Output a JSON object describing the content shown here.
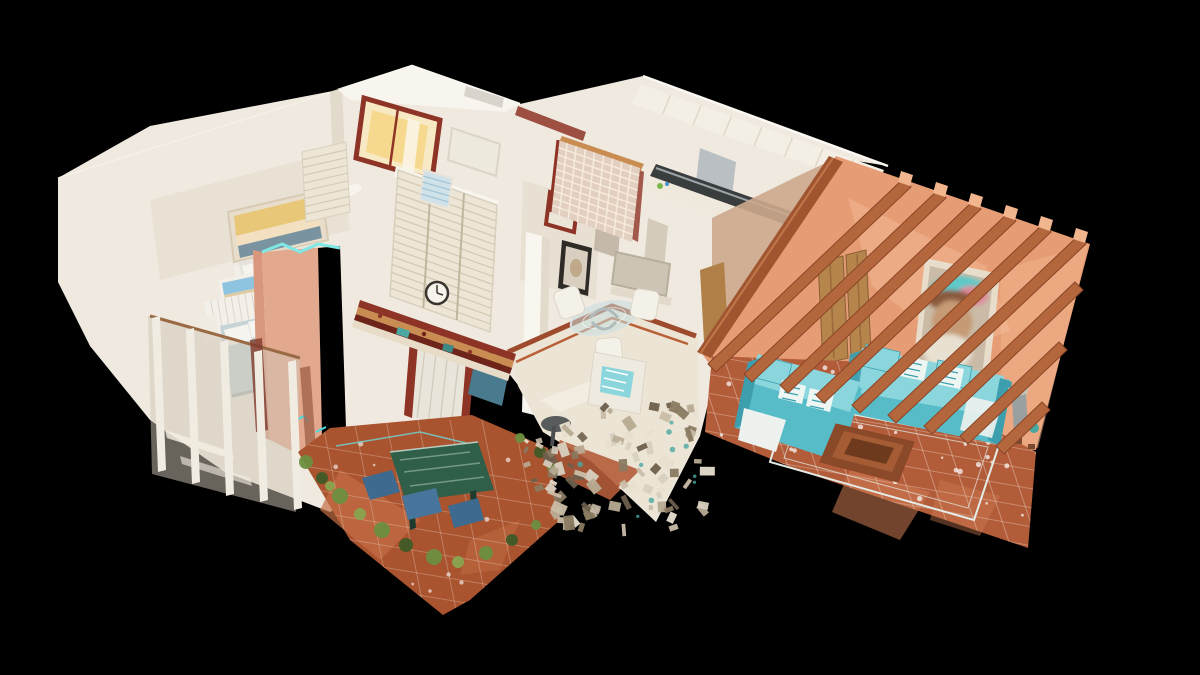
{
  "scene": {
    "description": "3D dollhouse cutaway scan of a villa viewed from above on black",
    "regions": [
      "upper-bathroom",
      "bedroom-upper",
      "bedroom-lower",
      "balcony",
      "chimney",
      "hallway",
      "kitchen",
      "dining-area",
      "patio-terrace",
      "lounge"
    ],
    "palette": {
      "bg": "#000000",
      "wall_white": "#efe9df",
      "wall_bright": "#f8f5ee",
      "wall_shadow": "#e2dacb",
      "wall_shadow2": "#cfc6b6",
      "wall_pink_shadow": "#cda98c",
      "pillar_bright": "#f9f6ef",
      "cream_floor": "#ece4d4",
      "floor_border_red": "#9e4a2c",
      "terracotta": "#b25c3a",
      "terracotta_light": "#cf7c52",
      "patio_floor": "#a9532f",
      "patio_light": "#c46e44",
      "salmon": "#e69c74",
      "salmon_light": "#f2b68e",
      "chimney_pink": "#e2a98f",
      "chimney_side": "#d9987e",
      "beam": "#b4673c",
      "beam_dark": "#8a4526",
      "beam_light": "#c98150",
      "ridge": "#a05530",
      "wood_door": "#b5854c",
      "gold": "#c9a24e",
      "gold_light": "#e2c678",
      "sofa": "#58bcc8",
      "sofa_light": "#8ad6dc",
      "sofa_dark": "#3d9fae",
      "cushion_white": "#eef6f4",
      "rug_line": "#e3ece6",
      "table_wood": "#8a4a2a",
      "table_wood_light": "#a55c34",
      "portrait_frame": "#e8ddcb",
      "portrait_inner": "#cabba6",
      "maroon": "#8e3426",
      "dark_red": "#6e2418",
      "tan": "#c98d52",
      "cream_strip": "#e8dcc8",
      "teal_deco": "#4aa8a0",
      "glass_block": "#e3cfc0",
      "glass_grid": "#f8eee2",
      "window_warm": "#f7e9c4",
      "window_glow": "#f6d98e",
      "curtain": "#e9e5da",
      "cabinet_blue": "#4a7a8e",
      "cabinet_blue_light": "#5f98a8",
      "marble_green": "#2f5e49",
      "marble_streak": "#86a895",
      "plant": "#6b8f3f",
      "plant_dark": "#3f5a26",
      "plant_light": "#88a44e",
      "chair_blue": "#3d6a8e",
      "chair_blue2": "#48759c",
      "sky_blue": "#8ec4e0",
      "sand": "#e2cba2",
      "sunset_sky": "#e8c878",
      "sea": "#7a93a0",
      "bed_blue": "#c6d4d8",
      "bed_white": "#e6e4dc",
      "pillow": "#f6f4ee",
      "radiator": "#f3f0e9",
      "rib": "#d9d4c9",
      "louver": "#d2c6ae",
      "wardrobe": "#ede6d7",
      "steel": "#b9bfc2",
      "steel_dark": "#a8aeb2",
      "counter_dark": "#3a3d3e",
      "clock_face": "#f6f3ea",
      "clock_rim": "#3a3430",
      "cyan_rim": "#7fe8e4",
      "cyan_floor": "#4ad8e0",
      "grout": "#f3e0d0",
      "white": "#ffffff",
      "blind_blue": "#cfe2ea",
      "blind_line": "#9fc4d4",
      "noise1": "#d8d0c0",
      "noise2": "#b8ab94",
      "noise3": "#8a7a62",
      "noise4": "#e8e0d0",
      "noise5": "#6e5f4c",
      "noise6": "#c9bda8"
    }
  }
}
